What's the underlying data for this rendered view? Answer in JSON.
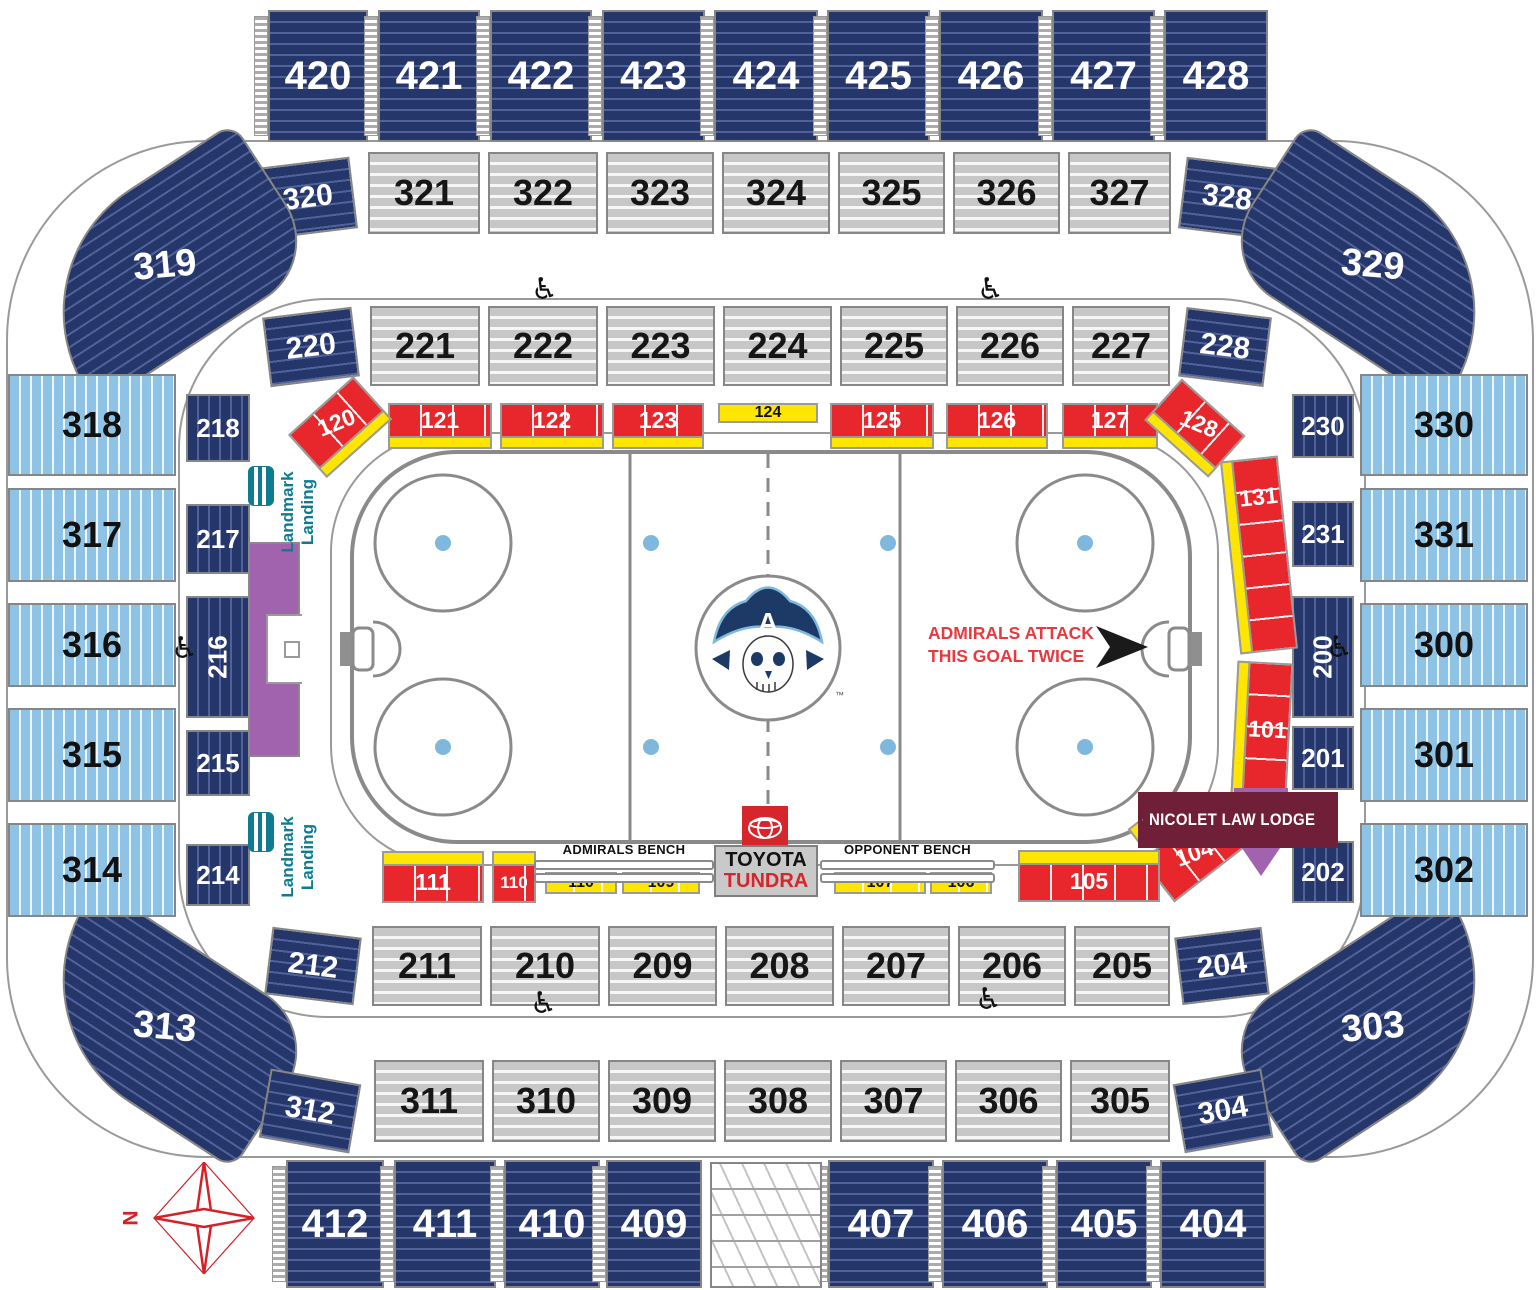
{
  "labels": {
    "nicolet": "NICOLET LAW LODGE",
    "attack1": "ADMIRALS ATTACK",
    "attack2": "THIS GOAL TWICE",
    "admirals_bench": "ADMIRALS BENCH",
    "opponent_bench": "OPPONENT BENCH",
    "toyota": "TOYOTA",
    "tundra": "TUNDRA",
    "landmark_word1": "Landmark",
    "landmark_word2": "Landing",
    "north": "N",
    "logo_letter": "A",
    "trademark": "™"
  },
  "colors": {
    "navy": "#25376a",
    "light_blue": "#8fc3e6",
    "gray": "#c7c7c7",
    "red": "#e8272d",
    "yellow": "#ffe602",
    "purple": "#a263ae",
    "maroon": "#6f1f38",
    "teal": "#0e7b91",
    "attack_red": "#e8393f",
    "compass_red": "#d42027"
  },
  "wheelchair_positions": [
    [
      531,
      275
    ],
    [
      977,
      275
    ],
    [
      171,
      634
    ],
    [
      1326,
      633
    ],
    [
      530,
      989
    ],
    [
      975,
      985
    ]
  ],
  "sections": [
    {
      "label": "420",
      "t": "n",
      "dir": "h",
      "x": 268,
      "y": 10,
      "w": 100,
      "h": 132,
      "fs": 40,
      "st": 1
    },
    {
      "label": "421",
      "t": "n",
      "dir": "h",
      "x": 378,
      "y": 10,
      "w": 102,
      "h": 132,
      "fs": 40,
      "st": 1
    },
    {
      "label": "422",
      "t": "n",
      "dir": "h",
      "x": 490,
      "y": 10,
      "w": 102,
      "h": 132,
      "fs": 40,
      "st": 1
    },
    {
      "label": "423",
      "t": "n",
      "dir": "h",
      "x": 602,
      "y": 10,
      "w": 103,
      "h": 132,
      "fs": 40,
      "st": 1
    },
    {
      "label": "424",
      "t": "n",
      "dir": "h",
      "x": 714,
      "y": 10,
      "w": 104,
      "h": 132,
      "fs": 40,
      "st": 1
    },
    {
      "label": "425",
      "t": "n",
      "dir": "h",
      "x": 827,
      "y": 10,
      "w": 103,
      "h": 132,
      "fs": 40,
      "st": 1
    },
    {
      "label": "426",
      "t": "n",
      "dir": "h",
      "x": 939,
      "y": 10,
      "w": 104,
      "h": 132,
      "fs": 40,
      "st": 1
    },
    {
      "label": "427",
      "t": "n",
      "dir": "h",
      "x": 1052,
      "y": 10,
      "w": 103,
      "h": 132,
      "fs": 40,
      "st": 1
    },
    {
      "label": "428",
      "t": "n",
      "dir": "h",
      "x": 1164,
      "y": 10,
      "w": 104,
      "h": 132,
      "fs": 40,
      "st": 1
    },
    {
      "label": "321",
      "t": "g",
      "x": 368,
      "y": 152,
      "w": 112,
      "h": 82,
      "fs": 36
    },
    {
      "label": "322",
      "t": "g",
      "x": 488,
      "y": 152,
      "w": 110,
      "h": 82,
      "fs": 36
    },
    {
      "label": "323",
      "t": "g",
      "x": 606,
      "y": 152,
      "w": 108,
      "h": 82,
      "fs": 36
    },
    {
      "label": "324",
      "t": "g",
      "x": 722,
      "y": 152,
      "w": 108,
      "h": 82,
      "fs": 36
    },
    {
      "label": "325",
      "t": "g",
      "x": 838,
      "y": 152,
      "w": 107,
      "h": 82,
      "fs": 36
    },
    {
      "label": "326",
      "t": "g",
      "x": 953,
      "y": 152,
      "w": 107,
      "h": 82,
      "fs": 36
    },
    {
      "label": "327",
      "t": "g",
      "x": 1068,
      "y": 152,
      "w": 103,
      "h": 82,
      "fs": 36
    },
    {
      "label": "320",
      "t": "n",
      "dir": "h",
      "x": 262,
      "y": 162,
      "w": 92,
      "h": 72,
      "fs": 30,
      "rot": -7
    },
    {
      "label": "328",
      "t": "n",
      "dir": "h",
      "x": 1182,
      "y": 162,
      "w": 90,
      "h": 72,
      "fs": 30,
      "rot": 7
    },
    {
      "label": "319",
      "t": "n",
      "dir": "h",
      "x": 30,
      "y": 182,
      "w": 270,
      "h": 166,
      "fs": 38,
      "rot": -33,
      "br": "150px 20px 70px 20px",
      "lrot": 28
    },
    {
      "label": "329",
      "t": "n",
      "dir": "h",
      "x": 1238,
      "y": 182,
      "w": 270,
      "h": 166,
      "fs": 38,
      "rot": 33,
      "br": "20px 150px 20px 70px",
      "lrot": -28
    },
    {
      "label": "313",
      "t": "n",
      "dir": "h",
      "x": 30,
      "y": 944,
      "w": 270,
      "h": 166,
      "fs": 38,
      "rot": 33,
      "br": "20px 70px 20px 150px",
      "lrot": -28
    },
    {
      "label": "303",
      "t": "n",
      "dir": "h",
      "x": 1238,
      "y": 944,
      "w": 270,
      "h": 166,
      "fs": 38,
      "rot": -33,
      "br": "70px 20px 150px 20px",
      "lrot": 28
    },
    {
      "label": "221",
      "t": "g",
      "x": 370,
      "y": 306,
      "w": 110,
      "h": 80,
      "fs": 36
    },
    {
      "label": "222",
      "t": "g",
      "x": 488,
      "y": 306,
      "w": 110,
      "h": 80,
      "fs": 36
    },
    {
      "label": "223",
      "t": "g",
      "x": 606,
      "y": 306,
      "w": 109,
      "h": 80,
      "fs": 36
    },
    {
      "label": "224",
      "t": "g",
      "x": 723,
      "y": 306,
      "w": 109,
      "h": 80,
      "fs": 36
    },
    {
      "label": "225",
      "t": "g",
      "x": 840,
      "y": 306,
      "w": 108,
      "h": 80,
      "fs": 36
    },
    {
      "label": "226",
      "t": "g",
      "x": 956,
      "y": 306,
      "w": 108,
      "h": 80,
      "fs": 36
    },
    {
      "label": "227",
      "t": "g",
      "x": 1072,
      "y": 306,
      "w": 98,
      "h": 80,
      "fs": 36
    },
    {
      "label": "220",
      "t": "n",
      "dir": "h",
      "x": 266,
      "y": 312,
      "w": 90,
      "h": 70,
      "fs": 30,
      "rot": -7
    },
    {
      "label": "228",
      "t": "n",
      "dir": "h",
      "x": 1182,
      "y": 312,
      "w": 86,
      "h": 70,
      "fs": 30,
      "rot": 7
    },
    {
      "label": "318",
      "t": "b",
      "dir": "v",
      "x": 8,
      "y": 374,
      "w": 168,
      "h": 102,
      "fs": 36
    },
    {
      "label": "317",
      "t": "b",
      "dir": "v",
      "x": 8,
      "y": 488,
      "w": 168,
      "h": 94,
      "fs": 36
    },
    {
      "label": "316",
      "t": "b",
      "dir": "v",
      "x": 8,
      "y": 603,
      "w": 168,
      "h": 84,
      "fs": 36
    },
    {
      "label": "315",
      "t": "b",
      "dir": "v",
      "x": 8,
      "y": 708,
      "w": 168,
      "h": 94,
      "fs": 36
    },
    {
      "label": "314",
      "t": "b",
      "dir": "v",
      "x": 8,
      "y": 823,
      "w": 168,
      "h": 94,
      "fs": 36
    },
    {
      "label": "330",
      "t": "b",
      "dir": "v",
      "x": 1360,
      "y": 374,
      "w": 168,
      "h": 102,
      "fs": 36
    },
    {
      "label": "331",
      "t": "b",
      "dir": "v",
      "x": 1360,
      "y": 488,
      "w": 168,
      "h": 94,
      "fs": 36
    },
    {
      "label": "300",
      "t": "b",
      "dir": "v",
      "x": 1360,
      "y": 603,
      "w": 168,
      "h": 84,
      "fs": 36
    },
    {
      "label": "301",
      "t": "b",
      "dir": "v",
      "x": 1360,
      "y": 708,
      "w": 168,
      "h": 94,
      "fs": 36
    },
    {
      "label": "302",
      "t": "b",
      "dir": "v",
      "x": 1360,
      "y": 823,
      "w": 168,
      "h": 94,
      "fs": 36
    },
    {
      "label": "218",
      "t": "n",
      "dir": "v",
      "x": 186,
      "y": 394,
      "w": 64,
      "h": 68,
      "fs": 26
    },
    {
      "label": "217",
      "t": "n",
      "dir": "v",
      "x": 186,
      "y": 504,
      "w": 64,
      "h": 70,
      "fs": 26
    },
    {
      "label": "216",
      "t": "n",
      "dir": "v",
      "x": 186,
      "y": 596,
      "w": 64,
      "h": 122,
      "fs": 26,
      "lrot": -90
    },
    {
      "label": "215",
      "t": "n",
      "dir": "v",
      "x": 186,
      "y": 730,
      "w": 64,
      "h": 66,
      "fs": 26
    },
    {
      "label": "214",
      "t": "n",
      "dir": "v",
      "x": 186,
      "y": 844,
      "w": 64,
      "h": 62,
      "fs": 26
    },
    {
      "label": "230",
      "t": "n",
      "dir": "v",
      "x": 1292,
      "y": 394,
      "w": 62,
      "h": 64,
      "fs": 26
    },
    {
      "label": "231",
      "t": "n",
      "dir": "v",
      "x": 1292,
      "y": 501,
      "w": 62,
      "h": 66,
      "fs": 26
    },
    {
      "label": "200",
      "t": "n",
      "dir": "v",
      "x": 1292,
      "y": 596,
      "w": 62,
      "h": 122,
      "fs": 26,
      "lrot": -90
    },
    {
      "label": "201",
      "t": "n",
      "dir": "v",
      "x": 1292,
      "y": 726,
      "w": 62,
      "h": 64,
      "fs": 26
    },
    {
      "label": "202",
      "t": "n",
      "dir": "v",
      "x": 1292,
      "y": 841,
      "w": 62,
      "h": 62,
      "fs": 26
    },
    {
      "label": "211",
      "t": "g",
      "x": 372,
      "y": 926,
      "w": 110,
      "h": 80,
      "fs": 36
    },
    {
      "label": "210",
      "t": "g",
      "x": 490,
      "y": 926,
      "w": 110,
      "h": 80,
      "fs": 36
    },
    {
      "label": "209",
      "t": "g",
      "x": 608,
      "y": 926,
      "w": 109,
      "h": 80,
      "fs": 36
    },
    {
      "label": "208",
      "t": "g",
      "x": 725,
      "y": 926,
      "w": 109,
      "h": 80,
      "fs": 36
    },
    {
      "label": "207",
      "t": "g",
      "x": 842,
      "y": 926,
      "w": 108,
      "h": 80,
      "fs": 36
    },
    {
      "label": "206",
      "t": "g",
      "x": 958,
      "y": 926,
      "w": 108,
      "h": 80,
      "fs": 36
    },
    {
      "label": "205",
      "t": "g",
      "x": 1074,
      "y": 926,
      "w": 96,
      "h": 80,
      "fs": 36
    },
    {
      "label": "212",
      "t": "n",
      "dir": "h",
      "x": 268,
      "y": 932,
      "w": 90,
      "h": 68,
      "fs": 30,
      "rot": 7
    },
    {
      "label": "204",
      "t": "n",
      "dir": "h",
      "x": 1178,
      "y": 932,
      "w": 88,
      "h": 68,
      "fs": 30,
      "rot": -7
    },
    {
      "label": "311",
      "t": "g",
      "x": 374,
      "y": 1060,
      "w": 110,
      "h": 82,
      "fs": 36
    },
    {
      "label": "310",
      "t": "g",
      "x": 492,
      "y": 1060,
      "w": 108,
      "h": 82,
      "fs": 36
    },
    {
      "label": "309",
      "t": "g",
      "x": 608,
      "y": 1060,
      "w": 108,
      "h": 82,
      "fs": 36
    },
    {
      "label": "308",
      "t": "g",
      "x": 724,
      "y": 1060,
      "w": 108,
      "h": 82,
      "fs": 36
    },
    {
      "label": "307",
      "t": "g",
      "x": 840,
      "y": 1060,
      "w": 107,
      "h": 82,
      "fs": 36
    },
    {
      "label": "306",
      "t": "g",
      "x": 955,
      "y": 1060,
      "w": 107,
      "h": 82,
      "fs": 36
    },
    {
      "label": "305",
      "t": "g",
      "x": 1070,
      "y": 1060,
      "w": 100,
      "h": 82,
      "fs": 36
    },
    {
      "label": "312",
      "t": "n",
      "dir": "h",
      "x": 264,
      "y": 1076,
      "w": 92,
      "h": 70,
      "fs": 30,
      "rot": 10
    },
    {
      "label": "304",
      "t": "n",
      "dir": "h",
      "x": 1178,
      "y": 1076,
      "w": 90,
      "h": 70,
      "fs": 30,
      "rot": -10
    },
    {
      "label": "412",
      "t": "n",
      "dir": "h",
      "x": 286,
      "y": 1160,
      "w": 98,
      "h": 128,
      "fs": 40,
      "st": 1
    },
    {
      "label": "411",
      "t": "n",
      "dir": "h",
      "x": 394,
      "y": 1160,
      "w": 102,
      "h": 128,
      "fs": 40,
      "st": 1
    },
    {
      "label": "410",
      "t": "n",
      "dir": "h",
      "x": 504,
      "y": 1160,
      "w": 96,
      "h": 128,
      "fs": 40,
      "st": 1
    },
    {
      "label": "409",
      "t": "n",
      "dir": "h",
      "x": 606,
      "y": 1160,
      "w": 96,
      "h": 128,
      "fs": 40,
      "st": 1
    },
    {
      "label": "407",
      "t": "n",
      "dir": "h",
      "x": 828,
      "y": 1160,
      "w": 106,
      "h": 128,
      "fs": 40,
      "st": 1
    },
    {
      "label": "406",
      "t": "n",
      "dir": "h",
      "x": 942,
      "y": 1160,
      "w": 106,
      "h": 128,
      "fs": 40,
      "st": 1
    },
    {
      "label": "405",
      "t": "n",
      "dir": "h",
      "x": 1056,
      "y": 1160,
      "w": 96,
      "h": 128,
      "fs": 40,
      "st": 1
    },
    {
      "label": "404",
      "t": "n",
      "dir": "h",
      "x": 1160,
      "y": 1160,
      "w": 106,
      "h": 128,
      "fs": 40,
      "st": 1
    },
    {
      "label": "",
      "id": "stairs-block",
      "t": "sb",
      "x": 710,
      "y": 1162,
      "w": 112,
      "h": 126
    },
    {
      "label": "121",
      "t": "r",
      "x": 388,
      "y": 403,
      "w": 104,
      "h": 46,
      "fs": 23,
      "ys": "b"
    },
    {
      "label": "122",
      "t": "r",
      "x": 500,
      "y": 403,
      "w": 104,
      "h": 46,
      "fs": 23,
      "ys": "b"
    },
    {
      "label": "123",
      "t": "r",
      "x": 612,
      "y": 403,
      "w": 92,
      "h": 46,
      "fs": 23,
      "ys": "b"
    },
    {
      "label": "124",
      "t": "y",
      "x": 718,
      "y": 403,
      "w": 100,
      "h": 20,
      "fs": 16
    },
    {
      "label": "125",
      "t": "r",
      "x": 830,
      "y": 403,
      "w": 104,
      "h": 46,
      "fs": 23,
      "ys": "b"
    },
    {
      "label": "126",
      "t": "r",
      "x": 946,
      "y": 403,
      "w": 102,
      "h": 46,
      "fs": 23,
      "ys": "b"
    },
    {
      "label": "127",
      "t": "r",
      "x": 1062,
      "y": 403,
      "w": 96,
      "h": 46,
      "fs": 23,
      "ys": "b"
    },
    {
      "label": "120",
      "t": "r",
      "x": 296,
      "y": 398,
      "w": 88,
      "h": 58,
      "fs": 23,
      "rot": -42,
      "ys": "b",
      "lrot": 20
    },
    {
      "label": "128",
      "t": "r",
      "x": 1152,
      "y": 400,
      "w": 86,
      "h": 56,
      "fs": 23,
      "rot": 42,
      "ys": "b",
      "lrot": -20
    },
    {
      "label": "131",
      "t": "r",
      "dir": "v",
      "x": 1230,
      "y": 458,
      "w": 58,
      "h": 194,
      "fs": 23,
      "rot": -6,
      "ys": "l",
      "lpos": "top"
    },
    {
      "label": "101",
      "t": "r",
      "dir": "v",
      "x": 1234,
      "y": 662,
      "w": 56,
      "h": 134,
      "fs": 23,
      "rot": 3,
      "ys": "l"
    },
    {
      "label": "104",
      "t": "r",
      "x": 1148,
      "y": 826,
      "w": 92,
      "h": 54,
      "fs": 23,
      "rot": -38,
      "lrot": 18
    },
    {
      "label": "",
      "id": "yellow-104",
      "t": "y",
      "x": 1130,
      "y": 816,
      "w": 36,
      "h": 20,
      "rot": -38
    },
    {
      "label": "105",
      "t": "r",
      "x": 1018,
      "y": 850,
      "w": 142,
      "h": 52,
      "fs": 23,
      "ys": "t"
    },
    {
      "label": "111",
      "t": "r",
      "x": 382,
      "y": 851,
      "w": 102,
      "h": 52,
      "fs": 23,
      "ys": "t"
    },
    {
      "label": "110",
      "id": "110-box",
      "t": "r",
      "x": 492,
      "y": 851,
      "w": 44,
      "h": 52,
      "fs": 17,
      "ys": "t"
    },
    {
      "label": "110",
      "id": "110-strip",
      "t": "ys",
      "x": 545,
      "y": 872,
      "w": 72,
      "h": 22,
      "fs": 16
    },
    {
      "label": "109",
      "t": "ys",
      "x": 622,
      "y": 872,
      "w": 78,
      "h": 22,
      "fs": 16
    },
    {
      "label": "107",
      "t": "ys",
      "x": 834,
      "y": 872,
      "w": 92,
      "h": 22,
      "fs": 16
    },
    {
      "label": "106",
      "t": "ys",
      "x": 930,
      "y": 872,
      "w": 62,
      "h": 22,
      "fs": 16
    },
    {
      "label": "",
      "id": "purple-left",
      "t": "p",
      "x": 248,
      "y": 542,
      "w": 52,
      "h": 215
    },
    {
      "label": "",
      "id": "purple-left-notch",
      "t": "w",
      "x": 266,
      "y": 614,
      "w": 36,
      "h": 70
    },
    {
      "label": "",
      "id": "purple-left-box",
      "t": "w2",
      "x": 284,
      "y": 641,
      "w": 16,
      "h": 17
    },
    {
      "label": "",
      "id": "purple-right",
      "t": "p2",
      "x": 1234,
      "y": 788,
      "w": 54,
      "h": 88
    }
  ]
}
